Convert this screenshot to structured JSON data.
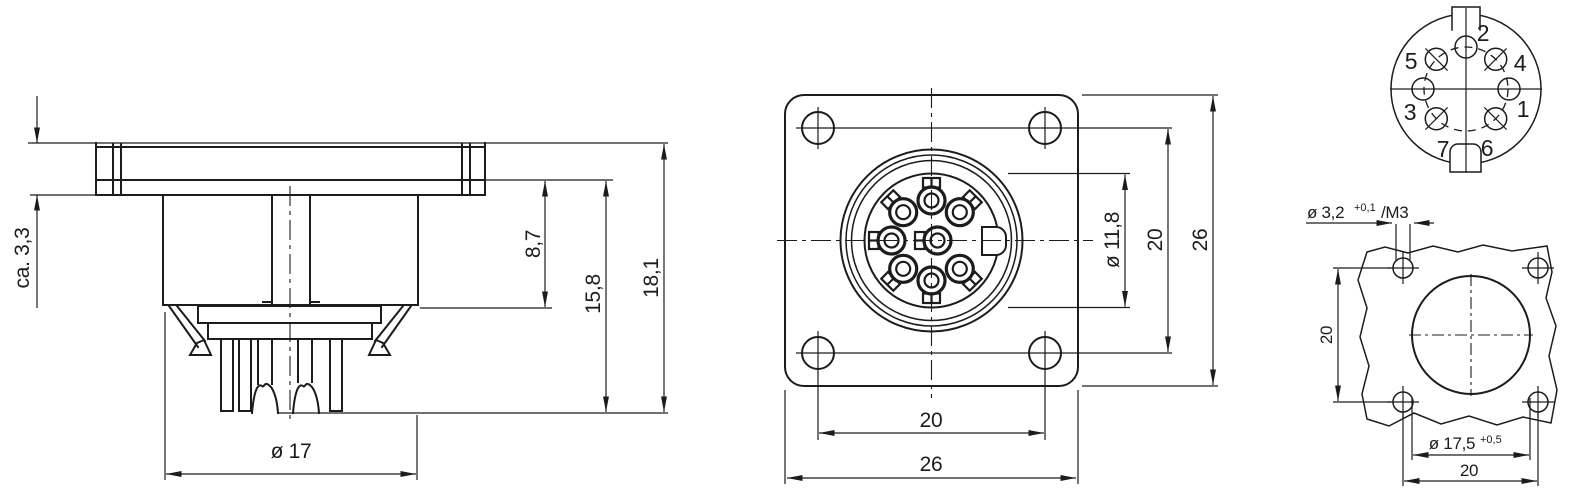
{
  "drawing": {
    "side_view": {
      "flange_thickness": "ca. 3,3",
      "step_height": "8,7",
      "insert_height": "15,8",
      "total_height": "18,1",
      "body_diameter": "ø 17"
    },
    "front_view": {
      "recess_diameter": "ø 11,8",
      "hole_spacing_vertical": "20",
      "flange_height": "26",
      "hole_spacing_horizontal": "20",
      "flange_width": "26"
    },
    "pinout": {
      "pin1": "1",
      "pin2": "2",
      "pin3": "3",
      "pin4": "4",
      "pin5": "5",
      "pin6": "6",
      "pin7": "7"
    },
    "panel_cutout": {
      "screw_hole_diameter": "ø 3,2",
      "screw_hole_tolerance": "+0,1",
      "screw_hole_thread": "/M3",
      "hole_spacing_vertical": "20",
      "cutout_diameter": "ø 17,5",
      "cutout_tolerance": "+0,5",
      "hole_spacing_horizontal": "20"
    },
    "colors": {
      "line": "#1c1c1c",
      "background": "#ffffff"
    }
  }
}
